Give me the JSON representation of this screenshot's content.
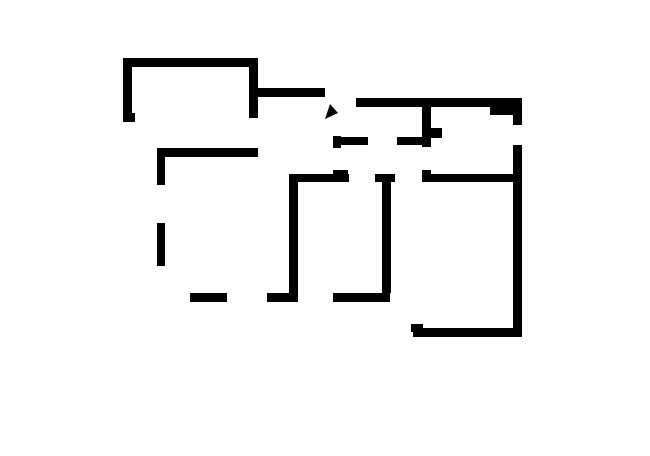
{
  "canvas": {
    "width": 650,
    "height": 456,
    "background": "#ffffff",
    "ink": "#000000"
  },
  "plan": {
    "rooms": [
      {
        "name": "room-bedroom",
        "x": 132,
        "y": 67,
        "w": 117,
        "h": 81
      },
      {
        "name": "room-hallway",
        "x": 258,
        "y": 97,
        "w": 75,
        "h": 77
      },
      {
        "name": "room-bathroom",
        "x": 344,
        "y": 107,
        "w": 78,
        "h": 30
      },
      {
        "name": "room-corridor",
        "x": 341,
        "y": 145,
        "w": 81,
        "h": 29
      },
      {
        "name": "room-kitchen",
        "x": 431,
        "y": 107,
        "w": 82,
        "h": 67
      },
      {
        "name": "room-living",
        "x": 165,
        "y": 157,
        "w": 124,
        "h": 136
      },
      {
        "name": "room-middle-left",
        "x": 298,
        "y": 182,
        "w": 84,
        "h": 111
      },
      {
        "name": "room-middle-right",
        "x": 391,
        "y": 182,
        "w": 122,
        "h": 146
      },
      {
        "name": "balcony-area",
        "x": 90,
        "y": 121,
        "w": 100,
        "h": 252
      }
    ],
    "walls": [
      {
        "name": "bedroom-top-wall",
        "x": 123,
        "y": 58,
        "w": 134,
        "h": 9
      },
      {
        "name": "bedroom-left-wall",
        "x": 123,
        "y": 58,
        "w": 9,
        "h": 57
      },
      {
        "name": "bedroom-left-wall-foot",
        "x": 123,
        "y": 113,
        "w": 12,
        "h": 9
      },
      {
        "name": "bedroom-right-wall",
        "x": 249,
        "y": 58,
        "w": 9,
        "h": 60
      },
      {
        "name": "bedroom-bottom-wall",
        "x": 157,
        "y": 148,
        "w": 101,
        "h": 9
      },
      {
        "name": "hall-top-wall",
        "x": 257,
        "y": 88,
        "w": 68,
        "h": 9
      },
      {
        "name": "main-top-wall",
        "x": 356,
        "y": 98,
        "w": 166,
        "h": 9
      },
      {
        "name": "top-right-block",
        "x": 490,
        "y": 107,
        "w": 23,
        "h": 8
      },
      {
        "name": "right-wall-upper",
        "x": 513,
        "y": 98,
        "w": 9,
        "h": 27
      },
      {
        "name": "right-wall-lower",
        "x": 513,
        "y": 145,
        "w": 9,
        "h": 192
      },
      {
        "name": "bottom-right-room-wall",
        "x": 413,
        "y": 328,
        "w": 109,
        "h": 9
      },
      {
        "name": "bottom-right-corner-post",
        "x": 411,
        "y": 324,
        "w": 12,
        "h": 8
      },
      {
        "name": "living-left-wall-upper",
        "x": 157,
        "y": 148,
        "w": 8,
        "h": 37
      },
      {
        "name": "living-left-wall-lower",
        "x": 157,
        "y": 223,
        "w": 8,
        "h": 43
      },
      {
        "name": "living-bottom-wall-left",
        "x": 190,
        "y": 293,
        "w": 37,
        "h": 9
      },
      {
        "name": "living-bottom-wall-mid",
        "x": 267,
        "y": 293,
        "w": 31,
        "h": 9
      },
      {
        "name": "living-bottom-wall-right",
        "x": 333,
        "y": 293,
        "w": 57,
        "h": 9
      },
      {
        "name": "middle-left-room-left-wall",
        "x": 289,
        "y": 174,
        "w": 9,
        "h": 128
      },
      {
        "name": "middle-divider-wall",
        "x": 382,
        "y": 182,
        "w": 9,
        "h": 111
      },
      {
        "name": "corridor-bottom-wall-a",
        "x": 292,
        "y": 174,
        "w": 57,
        "h": 8
      },
      {
        "name": "corridor-bottom-wall-b",
        "x": 375,
        "y": 174,
        "w": 20,
        "h": 8
      },
      {
        "name": "corridor-bottom-wall-c",
        "x": 422,
        "y": 174,
        "w": 92,
        "h": 8
      },
      {
        "name": "bathroom-bottom-wall-a",
        "x": 334,
        "y": 137,
        "w": 34,
        "h": 8
      },
      {
        "name": "bathroom-bottom-wall-b",
        "x": 397,
        "y": 137,
        "w": 30,
        "h": 8
      },
      {
        "name": "corridor-left-post-upper",
        "x": 333,
        "y": 136,
        "w": 8,
        "h": 12
      },
      {
        "name": "corridor-left-post-lower",
        "x": 333,
        "y": 170,
        "w": 15,
        "h": 12
      },
      {
        "name": "kitchen-left-wall",
        "x": 422,
        "y": 107,
        "w": 9,
        "h": 40
      },
      {
        "name": "kitchen-wall-tab",
        "x": 431,
        "y": 128,
        "w": 11,
        "h": 10
      },
      {
        "name": "kitchen-left-post-lower",
        "x": 422,
        "y": 170,
        "w": 9,
        "h": 12
      }
    ],
    "diagonal_walls": [
      {
        "name": "hall-diagonal-wall",
        "x1": 361,
        "y1": 101,
        "x2": 336,
        "y2": 140,
        "width": 10
      }
    ],
    "outline": {
      "name": "balcony-outline",
      "width": 2.6,
      "points": "123,121 90,152 124,184 124,268 90,302 157,370 188,341 353,341 387,373 412,336"
    },
    "openings": [
      {
        "name": "bedroom-door-opening",
        "width": 1.2,
        "lines": [
          [
            250.5,
            118,
            250.5,
            148
          ],
          [
            256.5,
            118,
            256.5,
            148
          ]
        ],
        "ticks": []
      },
      {
        "name": "living-left-window",
        "width": 1.2,
        "lines": [
          [
            159,
            185,
            159,
            223
          ],
          [
            163,
            185,
            163,
            223
          ]
        ],
        "ticks": []
      },
      {
        "name": "living-bottom-window",
        "width": 1.2,
        "lines": [
          [
            227,
            295.5,
            267,
            295.5
          ],
          [
            227,
            299.5,
            267,
            299.5
          ]
        ],
        "ticks": []
      },
      {
        "name": "middle-left-bottom-window",
        "width": 1.2,
        "lines": [
          [
            298,
            295.5,
            333,
            295.5
          ],
          [
            298,
            299.5,
            333,
            299.5
          ]
        ],
        "ticks": [
          [
            317,
            286,
            317,
            310
          ]
        ]
      },
      {
        "name": "right-room-bottom-window",
        "width": 1.2,
        "lines": [
          [
            450,
            330.5,
            490,
            330.5
          ],
          [
            450,
            334.5,
            490,
            334.5
          ]
        ],
        "ticks": []
      },
      {
        "name": "kitchen-exterior-window",
        "width": 1.2,
        "lines": [
          [
            516,
            125,
            516,
            145
          ],
          [
            520.5,
            125,
            520.5,
            145
          ],
          [
            512,
            125.5,
            525,
            125.5
          ],
          [
            512,
            144.5,
            525,
            144.5
          ]
        ],
        "ticks": []
      },
      {
        "name": "bathroom-door-opening",
        "width": 1.2,
        "lines": [
          [
            368,
            138.5,
            397,
            138.5
          ]
        ],
        "ticks": []
      },
      {
        "name": "middle-left-door-opening",
        "width": 1.2,
        "lines": [
          [
            349,
            180,
            375,
            180
          ]
        ],
        "ticks": []
      },
      {
        "name": "middle-right-door-opening",
        "width": 1.2,
        "lines": [
          [
            395,
            180,
            422,
            180
          ]
        ],
        "ticks": []
      },
      {
        "name": "corridor-hall-opening",
        "width": 1.2,
        "lines": [
          [
            334.5,
            148,
            334.5,
            170
          ],
          [
            339.5,
            148,
            339.5,
            170
          ]
        ],
        "ticks": []
      },
      {
        "name": "kitchen-door-opening",
        "width": 1.2,
        "lines": [
          [
            424,
            147,
            424,
            170
          ],
          [
            429,
            147,
            429,
            170
          ]
        ],
        "ticks": []
      },
      {
        "name": "hall-living-doorway",
        "width": 1.5,
        "lines": [
          [
            255,
            157,
            291,
            174
          ],
          [
            256,
            161,
            292,
            178
          ]
        ],
        "ticks": []
      },
      {
        "name": "bedroom-balcony-door",
        "width": 1.5,
        "lines": [
          [
            130,
            122,
            162,
            151
          ],
          [
            134,
            119,
            166,
            148
          ]
        ],
        "ticks": [
          [
            156,
            127,
            140,
            143
          ]
        ]
      },
      {
        "name": "living-balcony-door",
        "width": 1.5,
        "lines": [
          [
            157,
            266,
            189,
            298
          ],
          [
            161,
            263,
            193,
            295
          ]
        ],
        "ticks": [
          [
            184,
            272,
            164,
            289
          ]
        ]
      },
      {
        "name": "middle-right-balcony-door",
        "width": 1.5,
        "lines": [
          [
            388,
            298,
            416,
            326
          ],
          [
            392,
            295,
            420,
            323
          ]
        ],
        "ticks": [
          [
            412,
            303,
            396,
            319
          ]
        ]
      }
    ],
    "entrance": {
      "name": "entrance-door",
      "door_lines": [
        [
          325,
          91,
          359,
          125
        ],
        [
          328,
          88,
          362,
          122
        ]
      ],
      "tick": [
        329,
        109,
        352,
        90
      ],
      "arrow_shaft": [
        352,
        93,
        334,
        110
      ],
      "arrow_head": "325,119 338,113 330,104"
    }
  }
}
